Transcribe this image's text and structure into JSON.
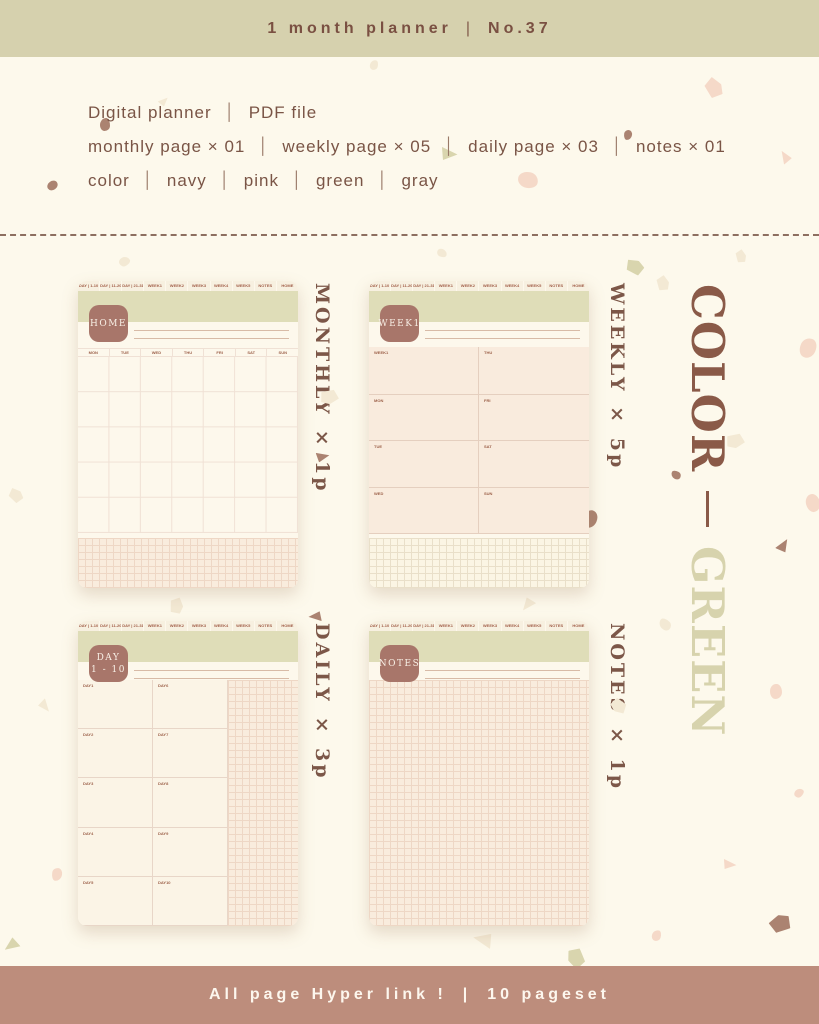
{
  "banner": {
    "left": "1 month planner",
    "separator": "|",
    "right": "No.37"
  },
  "info": {
    "separator": "│",
    "line1": [
      "Digital planner",
      "PDF file"
    ],
    "line2": [
      "monthly page × 01",
      "weekly page × 05",
      "daily page × 03",
      "notes × 01"
    ],
    "line3": [
      "color",
      "navy",
      "pink",
      "green",
      "gray"
    ]
  },
  "tabs": [
    "DAY | 1-10",
    "DAY | 11-20",
    "DAY | 21-31",
    "WEEK1",
    "WEEK2",
    "WEEK3",
    "WEEK4",
    "WEEK5",
    "NOTES",
    "HOME"
  ],
  "pages": {
    "monthly": {
      "badge": "HOME",
      "count_label": "MONTHLY × 1p",
      "day_headers": [
        "MON",
        "TUE",
        "WED",
        "THU",
        "FRI",
        "SAT",
        "SUN"
      ]
    },
    "weekly": {
      "badge": "WEEK1",
      "count_label": "WEEKLY × 5p",
      "cells": [
        "WEEK1",
        "MON",
        "TUE",
        "WED",
        "THU",
        "FRI",
        "SAT",
        "SUN"
      ]
    },
    "daily": {
      "badge_top": "DAY",
      "badge_bottom": "1 - 10",
      "count_label": "DAILY × 3p",
      "cells": [
        "DAY1",
        "DAY2",
        "DAY3",
        "DAY4",
        "DAY5",
        "DAY6",
        "DAY7",
        "DAY8",
        "DAY9",
        "DAY10"
      ]
    },
    "notes": {
      "badge": "NOTES",
      "count_label": "NOTES × 1p"
    }
  },
  "side_label": {
    "color_word": "COLOR",
    "variant_word": "GREEN"
  },
  "footer": {
    "left": "All page Hyper link !",
    "separator": "|",
    "right": "10 pageset"
  },
  "colors": {
    "banner-bg": "#d6d1ae",
    "banner-text": "#7a5042",
    "page-bg": "#fdf9ec",
    "text-brown": "#7a5546",
    "accent-brown": "#8a5a48",
    "accent-green": "#d7d3ad",
    "band-green": "#dfddb8",
    "badge-brown": "#a8766a",
    "footer-bg": "#bd8d7c",
    "footer-text": "#fdf7ee",
    "card-bg": "#fdf8ec",
    "grid-pink-bg": "#f9ecdd",
    "grid-pink-line": "#eed7c5",
    "weekly-body": "#f9ebdd",
    "line-color": "#d8bba7"
  }
}
